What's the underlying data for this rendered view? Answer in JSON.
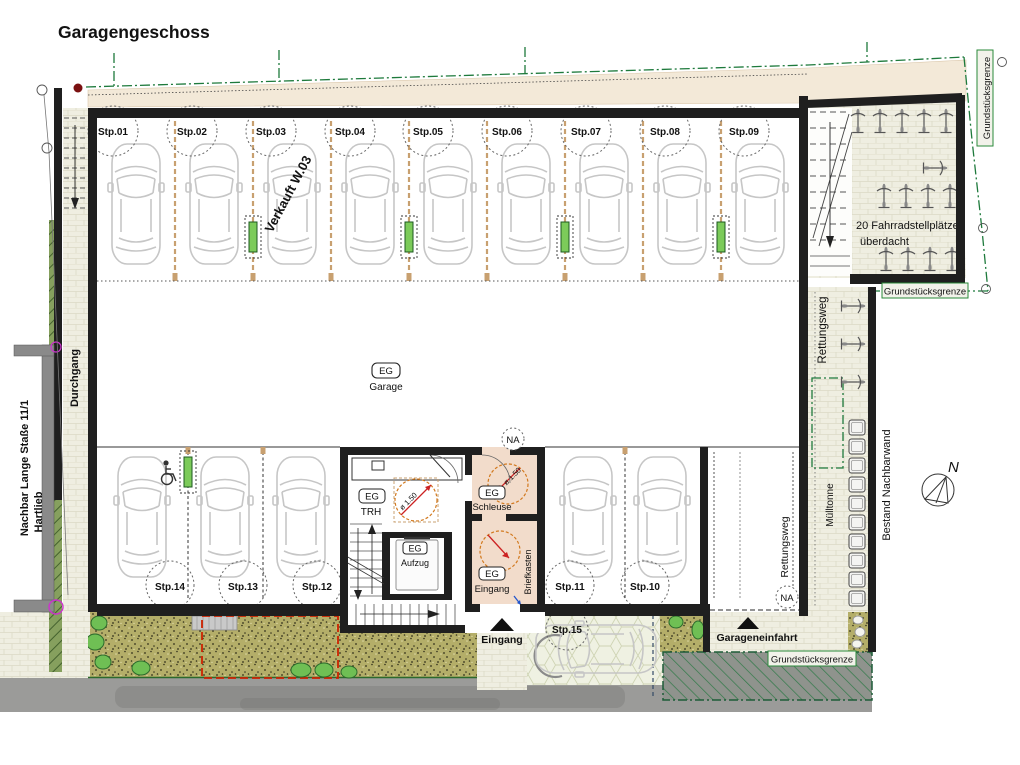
{
  "title": "Garagengeschoss",
  "stalls": {
    "upper": [
      "Stp.01",
      "Stp.02",
      "Stp.03",
      "Stp.04",
      "Stp.05",
      "Stp.06",
      "Stp.07",
      "Stp.08",
      "Stp.09"
    ],
    "lower": [
      "Stp.14",
      "Stp.13",
      "Stp.12",
      "Stp.11",
      "Stp.10"
    ],
    "outdoor": "Stp.15"
  },
  "rooms": {
    "level_tag": "EG",
    "garage": "Garage",
    "stairwell": "TRH",
    "elevator": "Aufzug",
    "airlock": "Schleuse",
    "entry": "Eingang"
  },
  "annotations": {
    "sold": "Verkauft  W.03",
    "bike_line1": "20 Fahrradstellplätze",
    "bike_line2": "überdacht",
    "property_line": "Grundstücksgrenze",
    "rescue_route": "Rettungsweg",
    "trash_bin": "Mülltonne",
    "existing_wall": "Bestand Nachbarwand",
    "passage": "Durchgang",
    "neighbor_line1": "Nachbar Lange Staße  11/1",
    "neighbor_line2": "Hartlieb",
    "mailbox": "Briefkasten",
    "entrance": "Eingang",
    "garage_entry": "Garageneinfahrt",
    "na": "NA",
    "north": "N",
    "turning_circle": "ø 1.50"
  },
  "colors": {
    "wall": "#1f1f1f",
    "property_green": "#1e7a3c",
    "sold_red": "#b51500",
    "turning_orange": "#d2791e",
    "room_pink": "#f2dccb",
    "garden_olive": "#b4ae69",
    "road_gray": "#9b9b99",
    "post_green": "#7ccb5a",
    "boundary_magenta": "#cc33cc"
  }
}
